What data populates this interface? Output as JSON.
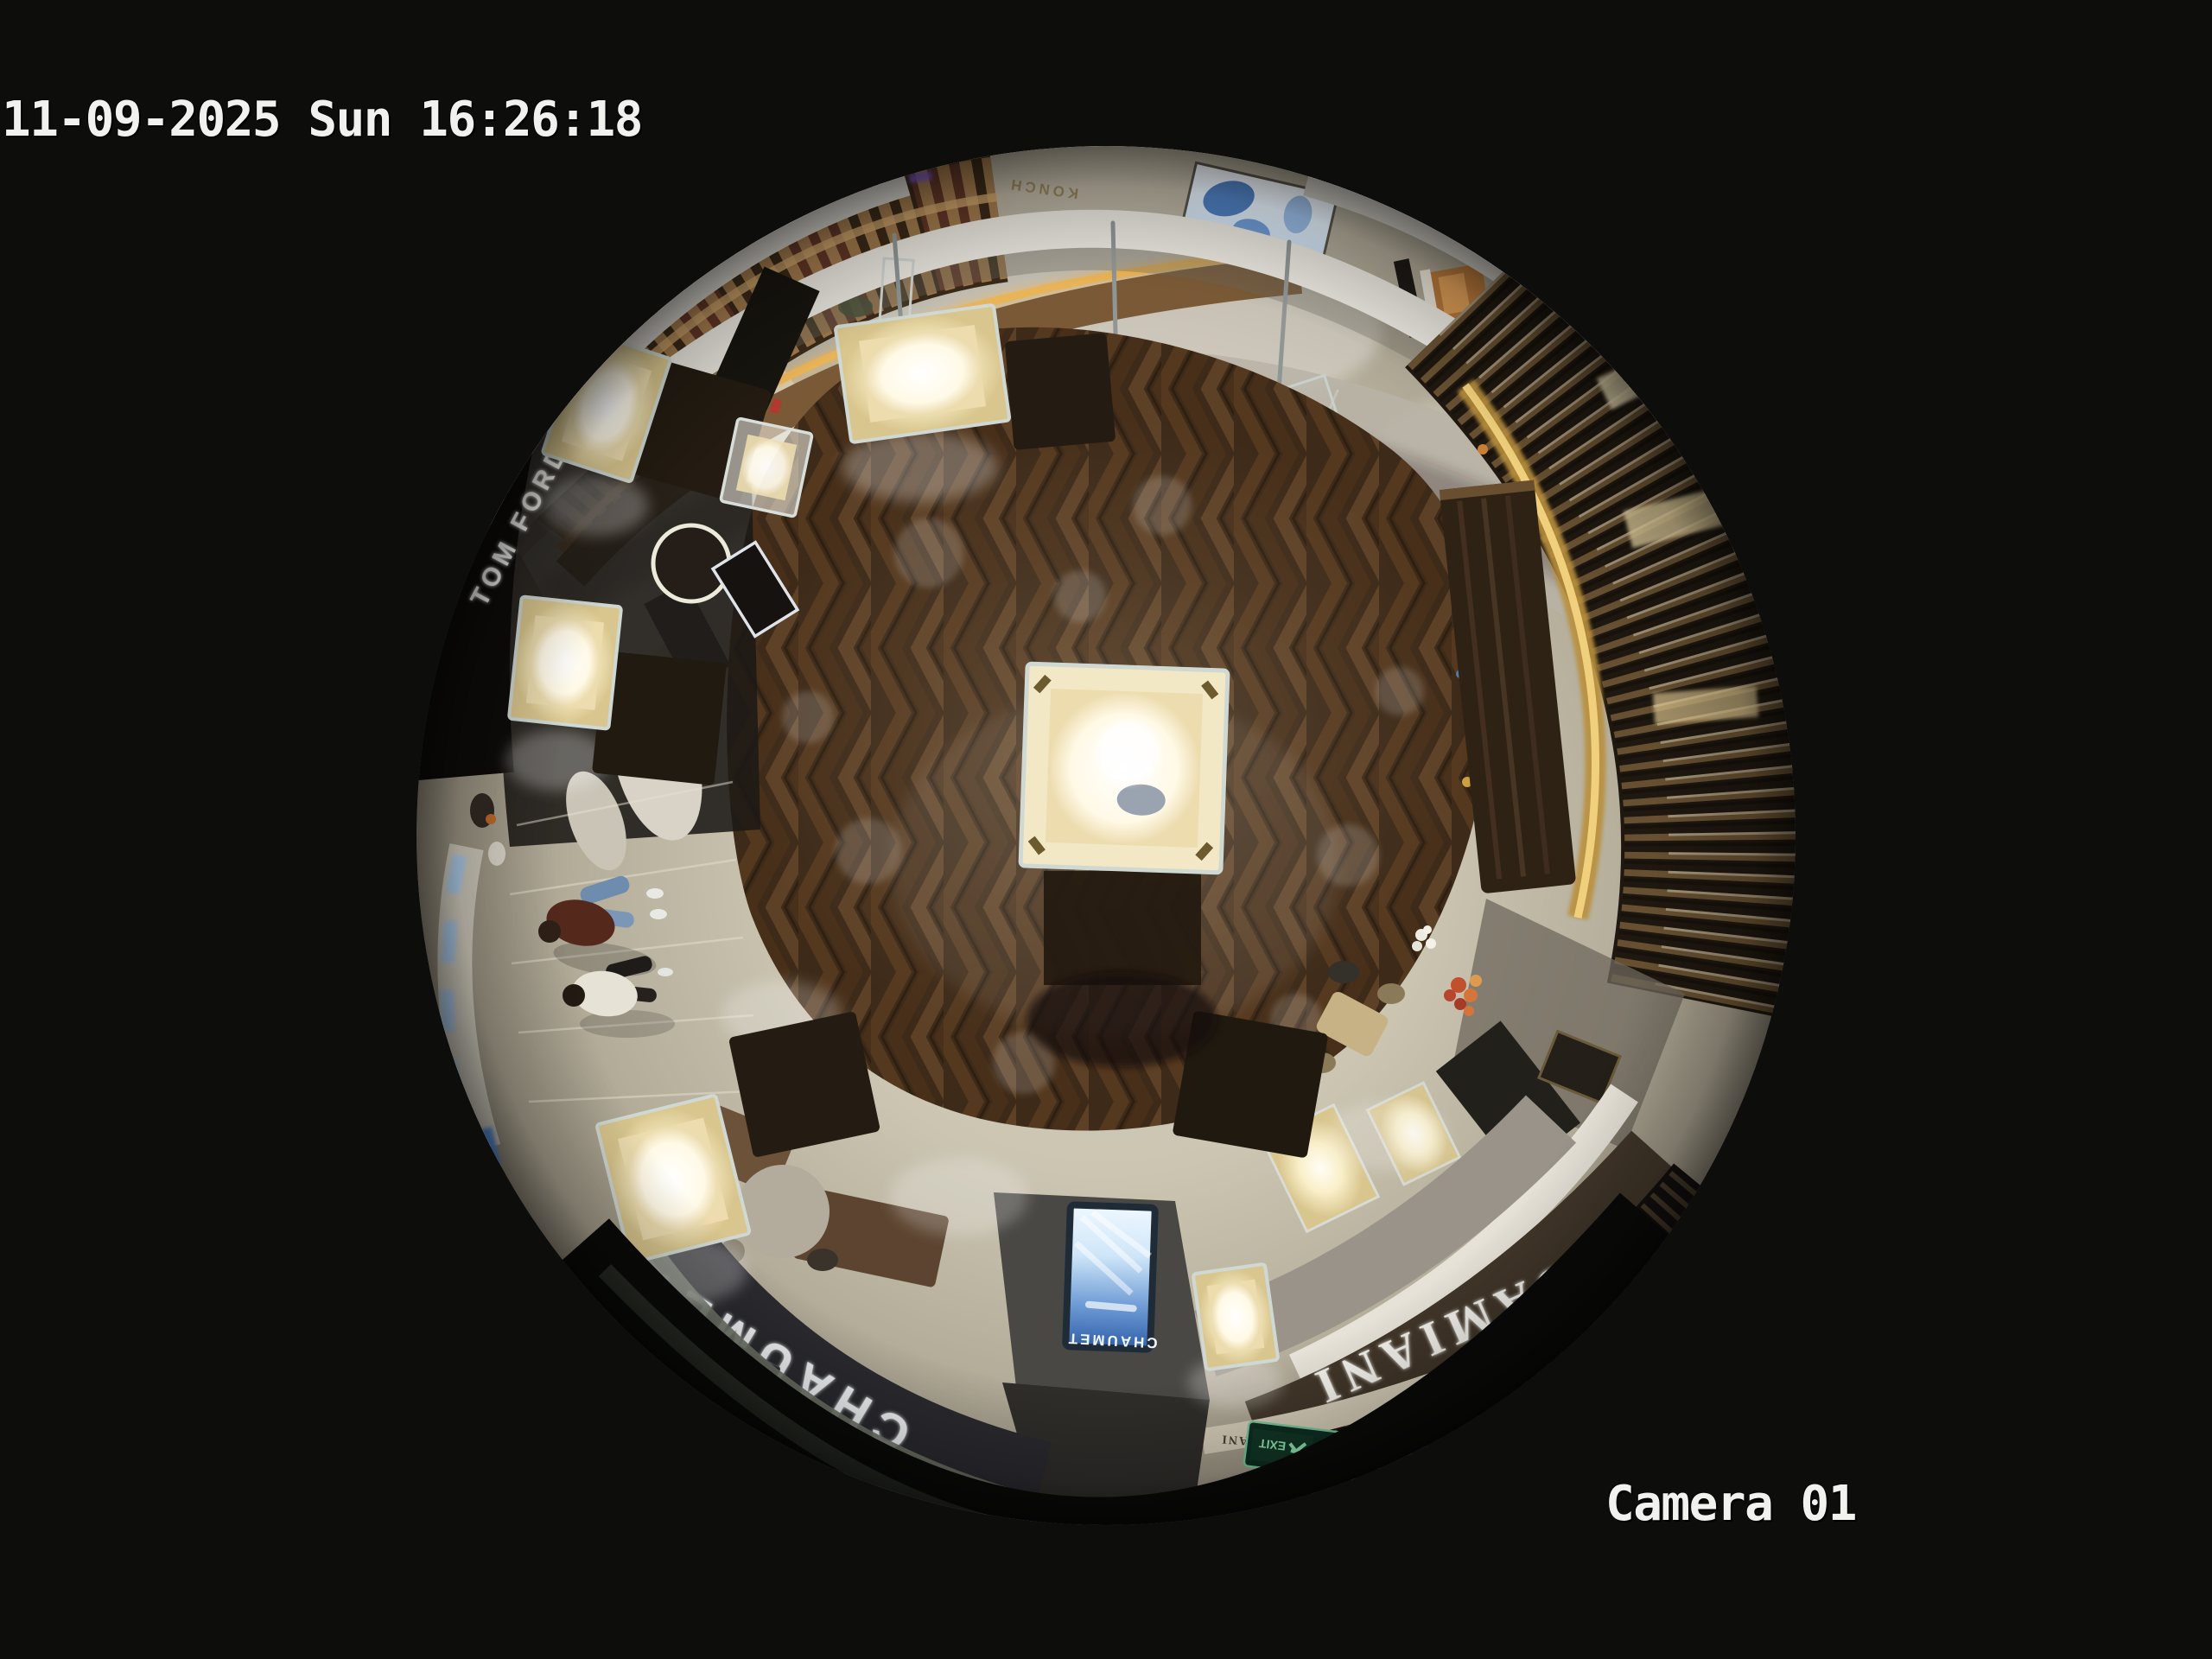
{
  "overlay": {
    "timestamp": "11-09-2025 Sun 16:26:18",
    "camera_label": "Camera 01",
    "text_color": "#f1f1ee"
  },
  "scene": {
    "description": "Overhead 360-degree fisheye CCTV frame of a luxury jewellery boutique with mall corridor",
    "signs": {
      "tom_ford": "TOM FORD",
      "chaumet_fascia": "CHAUMET",
      "chaumet_sign_small": "CHAUMET",
      "chaumet_screen": "CHAUMET",
      "damiani_fascia": "DAMIANI",
      "damiani_small": "DAMIANI",
      "exit_label": "EXIT",
      "mall_text": "KONCH"
    },
    "colors": {
      "background": "#0d0d0c",
      "wood_floor": "#4a3420",
      "tile_floor": "#c8c2b0",
      "corridor_marble": "#a49d8b",
      "fascia_white": "#e8e5dd",
      "vitrine_glow": "#fdf6dd",
      "slat_wood": "#6a5334",
      "led_gold": "#e9b357",
      "screen_blue": "#4a7ec6",
      "exit_green": "#8fe3b0",
      "chaumet_band": "#2b2b30",
      "damiani_band": "#42372a"
    }
  }
}
